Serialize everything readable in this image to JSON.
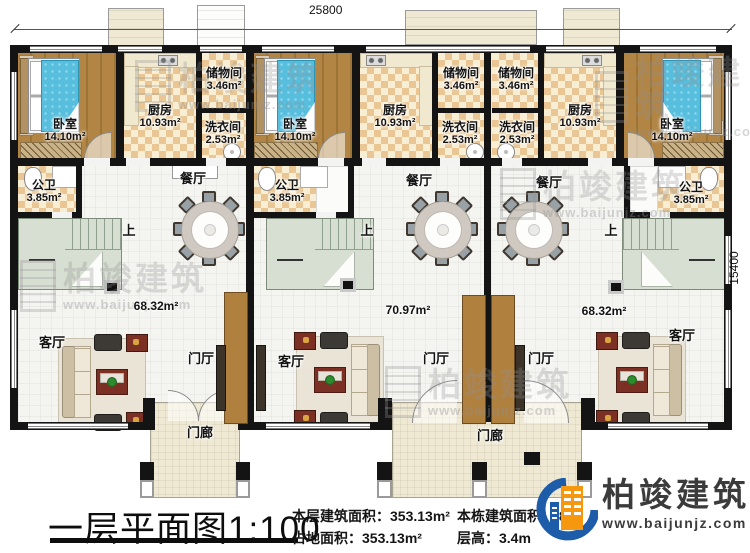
{
  "dims": {
    "top": "25800",
    "right": "15400"
  },
  "rooms": {
    "bedroom": {
      "name": "卧室",
      "area": "14.10m²"
    },
    "kitchen": {
      "name": "厨房",
      "area": "10.93m²"
    },
    "storage": {
      "name": "储物间",
      "area": "3.46m²"
    },
    "laundry": {
      "name": "洗衣间",
      "area": "2.53m²"
    },
    "bath": {
      "name": "公卫",
      "area": "3.85m²"
    },
    "dining": {
      "name": "餐厅"
    },
    "living": {
      "name": "客厅"
    },
    "foyer": {
      "name": "门厅"
    },
    "porch": {
      "name": "门廊"
    },
    "up": {
      "name": "上"
    }
  },
  "unit_areas": {
    "left": "68.32m²",
    "middle": "70.97m²",
    "right": "68.32m²"
  },
  "title": {
    "text": "一层平面图1:100"
  },
  "stats": {
    "floor_area_label": "本层建筑面积：",
    "floor_area_value": "353.13m²",
    "footprint_label": "占地面积：",
    "footprint_value": "353.13m²",
    "total_label": "本栋建筑面积：",
    "total_value_visible_fragment": ".8",
    "height_label": "层高：",
    "height_value": "3.4m"
  },
  "logo": {
    "name": "柏竣建筑",
    "url": "www.baijunjz.com"
  },
  "watermark": {
    "name": "柏竣建筑",
    "url": "www.baijunjz.com"
  },
  "colors": {
    "wall": "#141414",
    "wood_floor": "#ab8040",
    "tile_tan": "#e9c693",
    "tile_cream": "#f8eed3",
    "main_floor": "#f4f4f1",
    "porch": "#efe9d3",
    "stairs": "#d7ded2",
    "bed_blue": "#58bedd",
    "maroon": "#7c3024",
    "partition_brown": "#b0803f",
    "logo_blue": "#1c5ca8",
    "logo_orange": "#f5970f",
    "logo_text": "#3b3b3b"
  }
}
